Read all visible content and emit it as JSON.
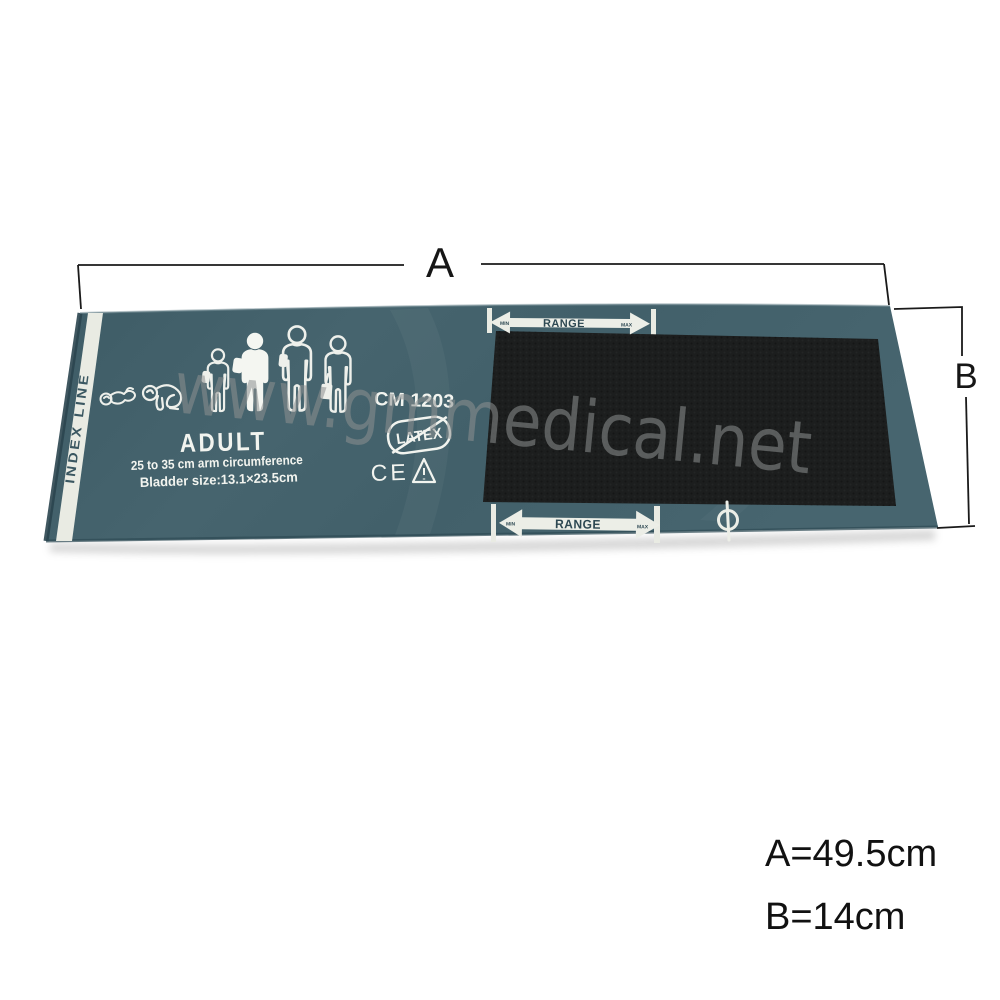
{
  "cuff": {
    "index_line": "INDEX LINE",
    "model": "CM 1203",
    "size_category": "ADULT",
    "arm_circumference": "25 to 35 cm arm circumference",
    "bladder_size": "Bladder size:13.1×23.5cm",
    "latex": "LATEX",
    "ce_mark": "CE",
    "range_top": {
      "label": "RANGE",
      "min": "MIN",
      "max": "MAX"
    },
    "range_bottom": {
      "label": "RANGE",
      "min": "MIN",
      "max": "MAX"
    }
  },
  "watermark": {
    "text": "www.gmmedical.net"
  },
  "dimensions": {
    "a_label": "A",
    "b_label": "B",
    "a_value": "A=49.5cm",
    "b_value": "B=14cm"
  },
  "colors": {
    "cuff_teal": "#44626c",
    "cuff_teal_light": "#4d6b75",
    "cuff_teal_dark": "#2e4a54",
    "velcro_black": "#1c1e1e",
    "print_white": "#f2f4ef",
    "stripe_white": "#e9ebe3",
    "range_text_dark": "#2d4852",
    "watermark_gray": "#8e9191",
    "dimension_black": "#1a1a1a"
  }
}
